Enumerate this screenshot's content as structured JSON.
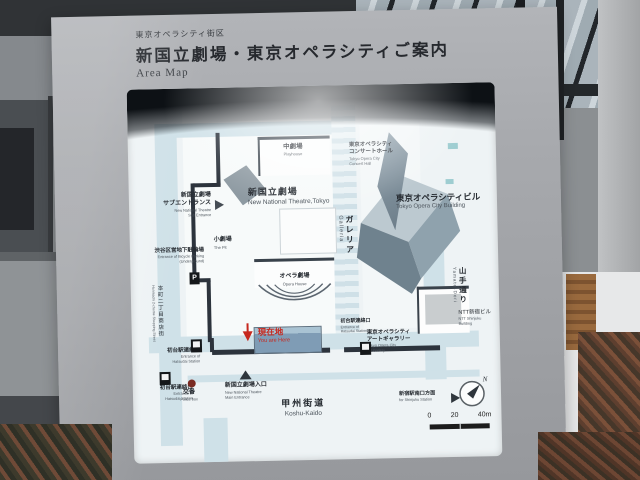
{
  "header": {
    "district": "東京オペラシティ街区",
    "title": "新国立劇場・東京オペラシティご案内",
    "subtitle": "Area Map"
  },
  "map": {
    "facilities": {
      "playhouse": {
        "jp": "中劇場",
        "en": "Playhouse"
      },
      "theatre": {
        "jp": "新国立劇場",
        "en": "New National Theatre,Tokyo"
      },
      "pit": {
        "jp": "小劇場",
        "en": "The Pit"
      },
      "opera_house": {
        "jp": "オペラ劇場",
        "en": "Opera House"
      },
      "concert_hall": {
        "jp1": "東京オペラシティ",
        "jp2": "コンサートホール",
        "en1": "Tokyo Opera City",
        "en2": "Concert Hall"
      },
      "opera_city_building": {
        "jp": "東京オペラシティビル",
        "en": "Tokyo Opera City Building"
      },
      "art_gallery": {
        "jp1": "東京オペラシティ",
        "jp2": "アートギャラリー",
        "en1": "Tokyo Opera City",
        "en2": "Art Gallery"
      },
      "ntt_building": {
        "jp": "NTT新宿ビル",
        "en1": "NTT Shinjuku",
        "en2": "Building"
      }
    },
    "streets": {
      "galleria": {
        "jp": "ガレリア",
        "en": "Galleria"
      },
      "yamate": {
        "jp": "山手通り",
        "en": "Yamate-Dori"
      },
      "koshu": {
        "jp": "甲州街道",
        "en": "Koshu-Kaido"
      },
      "honmachi": {
        "jp": "本町二丁目商店街",
        "en": "Honmachi 2-chome Shopping Street"
      }
    },
    "markers": {
      "sub_entrance": {
        "jp1": "新国立劇場",
        "jp2": "サブエントランス",
        "en1": "New National Theatre",
        "en2": "Sub Entrance"
      },
      "bicycle_parking": {
        "jp": "渋谷区営地下駐輪場",
        "en1": "Entrance of Bicycle Parking",
        "en2": "(Underground)"
      },
      "hatsudai": {
        "jp": "初台駅連絡口",
        "en1": "Entrance of",
        "en2": "Hatsudai Station"
      },
      "police_box": {
        "jp": "交番",
        "en": "Police box"
      },
      "main_entrance": {
        "jp": "新国立劇場入口",
        "en1": "New National Theatre",
        "en2": "Main Entrance"
      },
      "you_are_here": {
        "jp": "現在地",
        "en": "You are Here"
      },
      "shinjuku_direction": {
        "jp": "新宿駅南口方面",
        "en": "for Shinjuku Station"
      }
    },
    "icons": {
      "parking": "P"
    },
    "compass": {
      "label": "N"
    },
    "scale": {
      "t0": "0",
      "t1": "20",
      "t2": "40m"
    }
  },
  "colors": {
    "sign_gray": "#a7a9ad",
    "road_blue": "#cfe1e8",
    "accent_red": "#c6281e",
    "building_dark": "#2c333c"
  }
}
